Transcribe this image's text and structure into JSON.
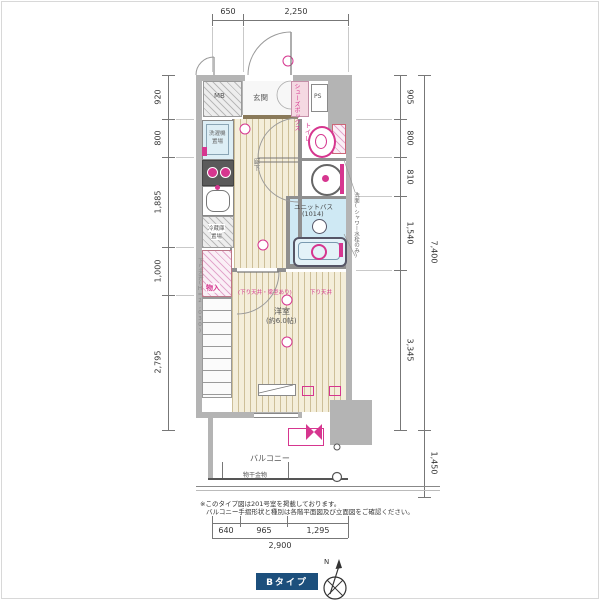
{
  "plan": {
    "type_badge": "Bタイプ",
    "compass": {
      "north": "N"
    },
    "rooms": {
      "mb": "MB",
      "genkan": "玄関",
      "shoes_box": "シューズボックス",
      "ps": "PS",
      "toilet": "トイレ",
      "hallway": "廊下",
      "unit_bath": "ユニットバス",
      "unit_bath_size": "(1014)",
      "western_room": "洋室",
      "western_room_size": "(約6.0帖)",
      "closet": "物入",
      "balcony": "バルコニー",
      "washer_line1": "洗濯機",
      "washer_line2": "置場",
      "fridge_line1": "冷蔵庫",
      "fridge_line2": "置場"
    },
    "annotations": {
      "laundry_hardware": "物干金物",
      "dropped_ceiling_side": "下り天井(H=2,030)",
      "dropped_ceiling_room": "(下り天井・梁型あり)",
      "dropped_ceiling_room2": "下り天井",
      "right_callout": "洗面(シャワー水栓のみ)"
    },
    "dimensions": {
      "top": [
        "650",
        "2,250"
      ],
      "left": [
        "920",
        "800",
        "1,885",
        "1,000",
        "2,795"
      ],
      "right_inner": [
        "905",
        "800",
        "810",
        "1,540",
        "3,345"
      ],
      "right_total": "7,400",
      "right_lower": "1,450",
      "bottom": [
        "640",
        "965",
        "1,295"
      ],
      "bottom_total": "2,900"
    },
    "notes": [
      "※このタイプ図は201号室を掲載しております。",
      "バルコニー手摺形状と種別は各階平面図及び立面図をご確認ください。"
    ],
    "colors": {
      "accent_pink": "#d6368f",
      "badge_navy": "#1c4f7c",
      "wall_gray": "#b4b4b4",
      "bath_blue": "#cfe9f4"
    }
  }
}
